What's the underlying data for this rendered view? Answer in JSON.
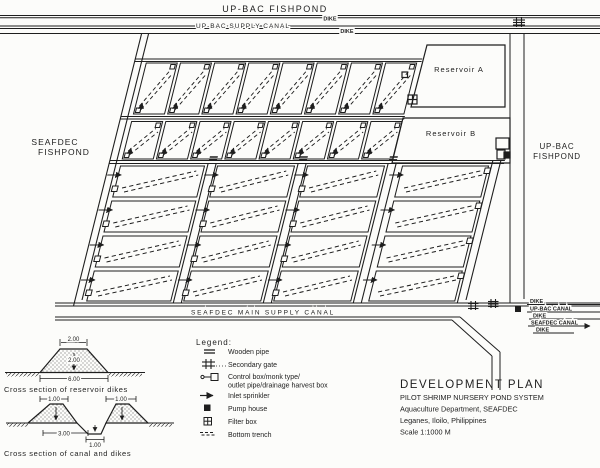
{
  "surroundings": {
    "top_fishpond": "UP-BAC FISHPOND",
    "left_fishpond_line1": "SEAFDEC",
    "left_fishpond_line2": "FISHPOND",
    "right_fishpond_line1": "UP-BAC",
    "right_fishpond_line2": "FISHPOND"
  },
  "canals": {
    "top_supply": "UP-BAC SUPPLY CANAL",
    "main_supply": "SEAFDEC MAIN SUPPLY CANAL",
    "dike_top_1": "DIKE",
    "dike_top_2": "DIKE",
    "right_stack": {
      "dike1": "DIKE",
      "upbac_canal": "UP-BAC CANAL",
      "dike2": "DIKE",
      "seafdec_canal": "SEAFDEC CANAL",
      "dike3": "DIKE"
    }
  },
  "reservoirs": {
    "a": "Reservoir A",
    "b": "Reservoir B"
  },
  "legend": {
    "title": "Legend:",
    "items": [
      {
        "icon": "wooden-pipe-icon",
        "label": "Wooden pipe"
      },
      {
        "icon": "secondary-gate-icon",
        "label": "Secondary gate"
      },
      {
        "icon": "control-box-icon",
        "label": "Control box/monk type/",
        "label2": "outlet pipe/drainage harvest box"
      },
      {
        "icon": "inlet-sprinkler-icon",
        "label": "Inlet sprinkler"
      },
      {
        "icon": "pump-house-icon",
        "label": "Pump house"
      },
      {
        "icon": "filter-box-icon",
        "label": "Filter box"
      },
      {
        "icon": "bottom-trench-icon",
        "label": "Bottom trench"
      }
    ]
  },
  "title_block": {
    "line1": "DEVELOPMENT PLAN",
    "line2": "PILOT SHRIMP NURSERY POND SYSTEM",
    "line3": "Aquaculture Department, SEAFDEC",
    "line4": "Leganes, Iloilo, Philippines",
    "line5": "Scale  1:1000 M"
  },
  "cross_sections": {
    "reservoir": {
      "caption": "Cross section of reservoir dikes",
      "top_width": "2.00",
      "height": "2.00",
      "base_width": "6.00"
    },
    "canal": {
      "caption": "Cross section of canal and dikes",
      "dike1_top": "1.00",
      "dike2_top": "1.00",
      "canal_span": "3.00",
      "bottom_width": "1.00"
    }
  },
  "plan": {
    "nursery_rows": 2,
    "nursery_cols": 8,
    "grow_rows": 4,
    "grow_cols": 4
  },
  "colors": {
    "ink": "#1e1e1e",
    "paper": "#fcfcfa"
  }
}
